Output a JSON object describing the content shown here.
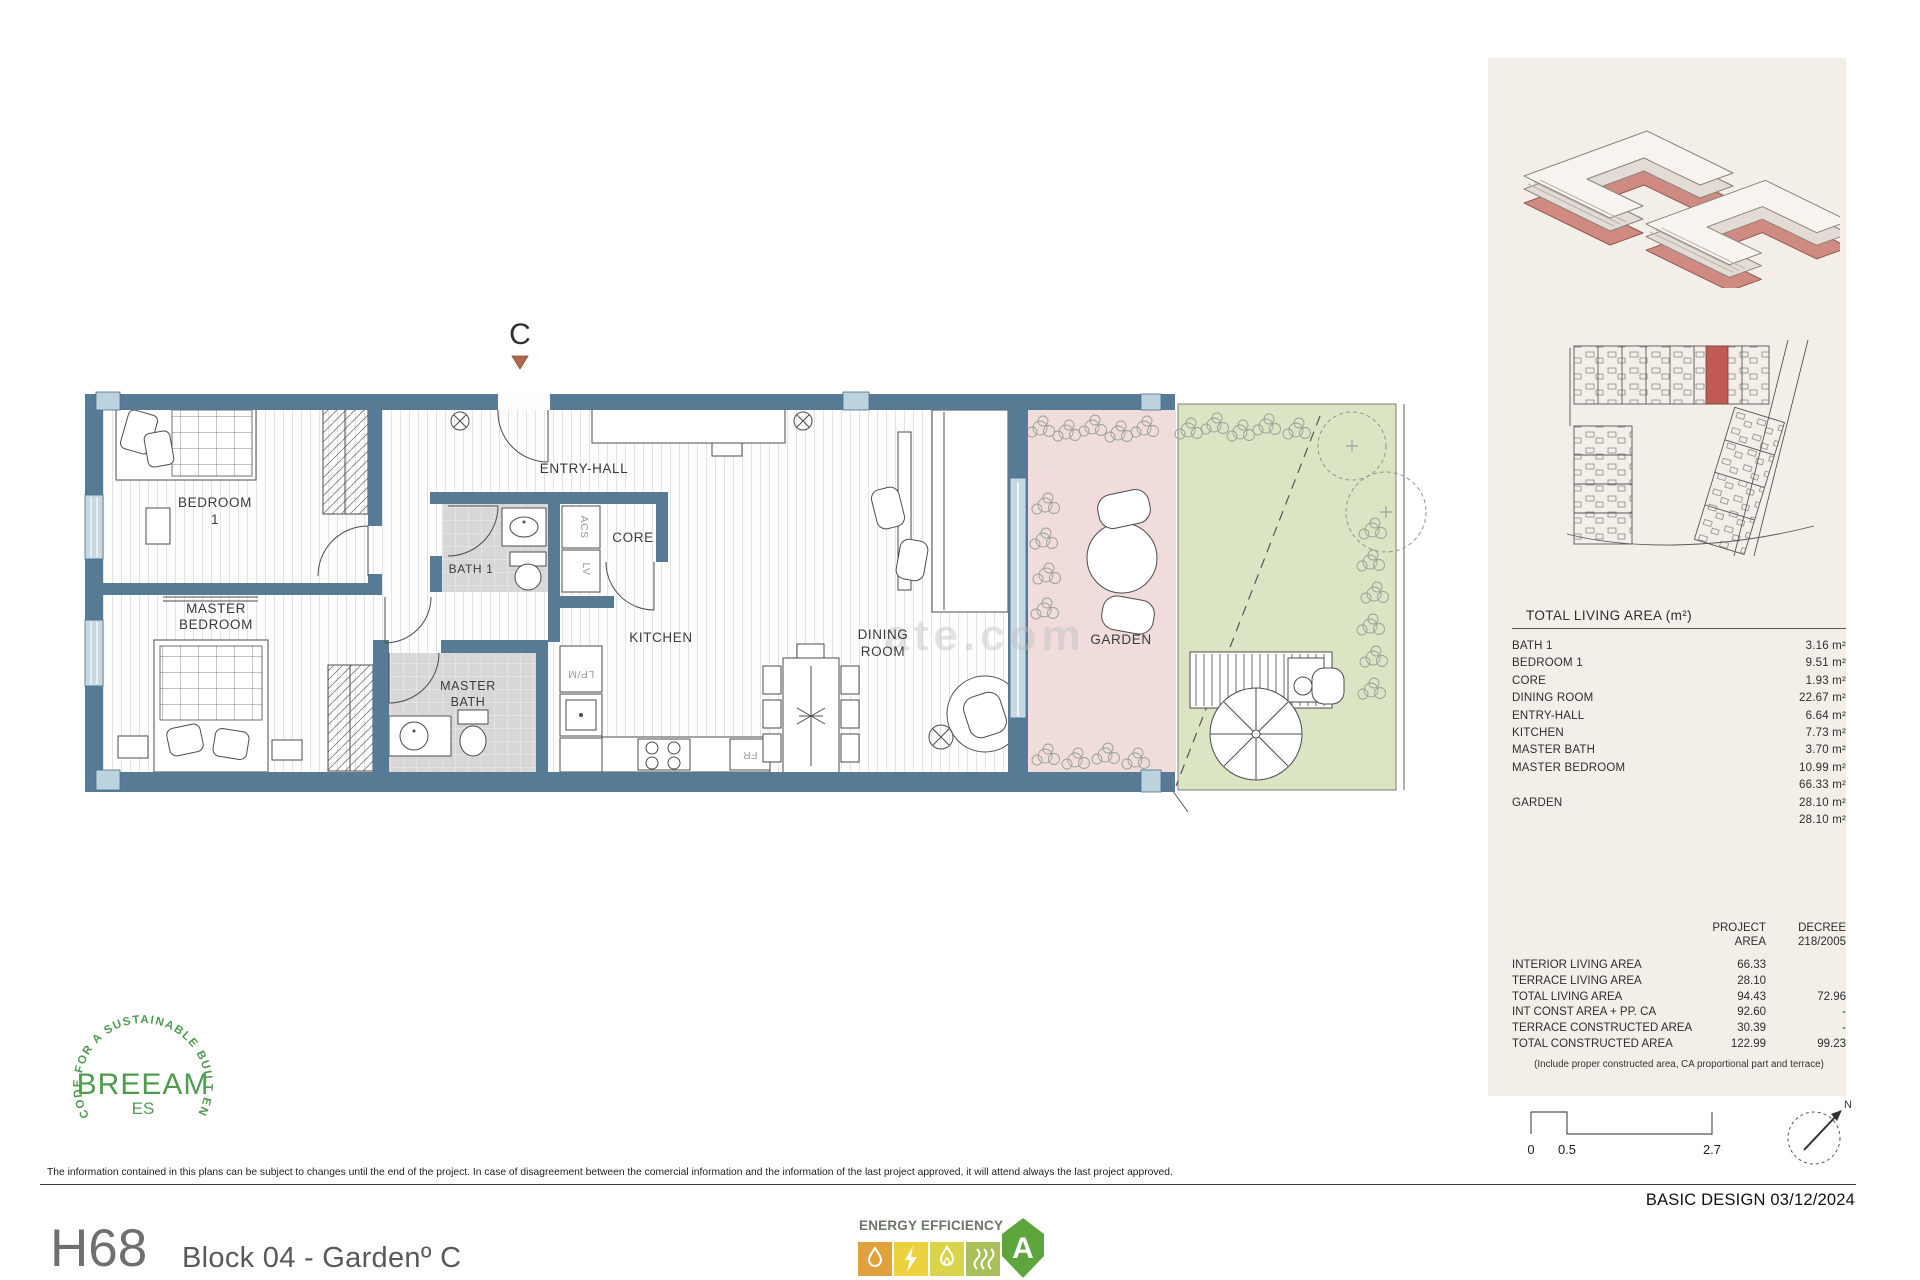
{
  "plan": {
    "section_marker": "C",
    "watermark": "ate.com",
    "labels": {
      "bedroom1_l1": "BEDROOM",
      "bedroom1_l2": "1",
      "master_bedroom_l1": "MASTER",
      "master_bedroom_l2": "BEDROOM",
      "bath1": "BATH 1",
      "master_bath_l1": "MASTER",
      "master_bath_l2": "BATH",
      "entry_hall": "ENTRY-HALL",
      "core": "CORE",
      "kitchen": "KITCHEN",
      "dining_l1": "DINING",
      "dining_l2": "ROOM",
      "garden": "GARDEN",
      "acs": "ACS",
      "lv": "LV",
      "lpm": "LP/M",
      "fr": "FR"
    }
  },
  "sidebar": {
    "area_table": {
      "title": "TOTAL LIVING AREA (m²)",
      "rows": [
        {
          "label": "BATH 1",
          "value": "3.16 m²"
        },
        {
          "label": "BEDROOM 1",
          "value": "9.51 m²"
        },
        {
          "label": "CORE",
          "value": "1.93 m²"
        },
        {
          "label": "DINING ROOM",
          "value": "22.67 m²"
        },
        {
          "label": "ENTRY-HALL",
          "value": "6.64 m²"
        },
        {
          "label": "KITCHEN",
          "value": "7.73 m²"
        },
        {
          "label": "MASTER BATH",
          "value": "3.70 m²"
        },
        {
          "label": "MASTER BEDROOM",
          "value": "10.99 m²"
        },
        {
          "label": "",
          "value": "66.33 m²"
        },
        {
          "label": "GARDEN",
          "value": "28.10 m²"
        },
        {
          "label": "",
          "value": "28.10 m²"
        }
      ]
    },
    "summary_table": {
      "header_project_l1": "PROJECT",
      "header_project_l2": "AREA",
      "header_decree_l1": "DECREE",
      "header_decree_l2": "218/2005",
      "rows": [
        {
          "label": "INTERIOR LIVING AREA",
          "project": "66.33",
          "decree": ""
        },
        {
          "label": "TERRACE LIVING AREA",
          "project": "28.10",
          "decree": ""
        },
        {
          "label": "TOTAL LIVING AREA",
          "project": "94.43",
          "decree": "72.96"
        },
        {
          "label": "INT CONST AREA + PP. CA",
          "project": "92.60",
          "decree": "-"
        },
        {
          "label": "TERRACE CONSTRUCTED AREA",
          "project": "30.39",
          "decree": "-"
        },
        {
          "label": "TOTAL CONSTRUCTED AREA",
          "project": "122.99",
          "decree": "99.23"
        }
      ],
      "footnote": "(Include proper constructed area, CA proportional part and terrace)"
    },
    "scale_bar": {
      "labels": [
        "0",
        "0.5",
        "2.7"
      ]
    },
    "compass_label": "N",
    "stamp": "BASIC DESIGN 03/12/2024"
  },
  "footer": {
    "disclaimer": "The information contained in this plans can be subject to changes until the end of the project. In case of disagreement between the comercial information and the information of the last project approved, it will attend always the last project approved.",
    "unit_code": "H68",
    "unit_title": "Block 04 -  Gardenº C"
  },
  "breeam": {
    "ring_text": "CODE FOR A SUSTAINABLE BUILT ENVIRONMENT",
    "name": "BREEAM",
    "region": "ES"
  },
  "energy": {
    "title": "ENERGY EFFICIENCY",
    "rating": "A"
  },
  "colors": {
    "wall": "#587b95",
    "terrace_pink": "#f0dcdb",
    "lawn_green": "#dbe5c4",
    "panel_beige": "#f3eee8",
    "highlight_red": "#bf5b52",
    "energy_green": "#5fa53e",
    "breeam_green": "#4f9b4f"
  }
}
